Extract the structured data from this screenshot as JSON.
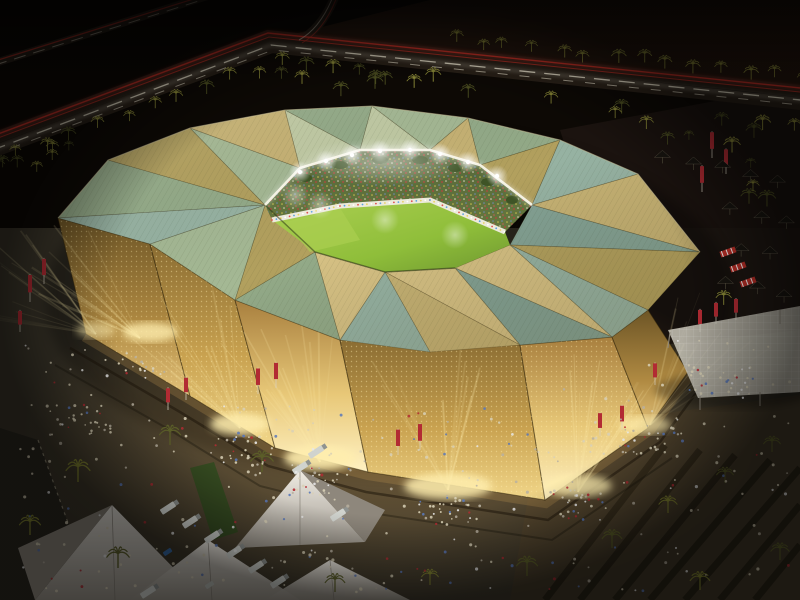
{
  "scene": {
    "alt": "Night aerial architectural rendering of a golden stadium with a folded green-and-gold faceted roof, an open glowing bowl with floodlit pitch and packed stands, perforated gold walls beaming light onto terraced plazas with crowds, red banners, palm trees, white tents with trucks, parasol rows, a mesh event canopy and a highway with red and white light trails"
  },
  "palette": {
    "sky": "#140d07",
    "ground_dark": "#0d0905",
    "ground_warm": "#2a1a10",
    "plaza": "#3b362a",
    "plaza_warm": "#6a583a",
    "road": "#2a2118",
    "trail_red": "#d63328",
    "trail_white": "#f0e8d2",
    "palm_dark": "#4f5222",
    "palm_lit": "#95943c",
    "palm_fore": "#5c5f28",
    "roof_sage": "#a4b894",
    "roof_sage2": "#93aa88",
    "roof_teal": "#96b2a2",
    "roof_teal2": "#84a294",
    "roof_pale": "#c0caa4",
    "roof_gold": "#c6b274",
    "roof_gold2": "#b2a05e",
    "roof_gold3": "#d6c184",
    "wall_top": "#8a6c32",
    "wall_gold": "#c9a250",
    "wall_bright": "#f2d78a",
    "glow": "#ffeeae",
    "pitch": "#8fbe3a",
    "pitch_light": "#accf52",
    "pitch_dark": "#6f9830",
    "stands": "#66783e",
    "stands_dark": "#55673a",
    "rim_band": "#eceadb",
    "cornice": "#f8f4e4",
    "banner_red": "#b22b33",
    "tent": "#dcd7cd",
    "tent_shadow": "#8e877c",
    "truck": "#d0d3ce",
    "car_blue": "#3a6fae",
    "canopy": "#c9c6b8",
    "crowd": "#d8d0b6",
    "foliage": "#3e5426",
    "stall_red": "#c03028"
  }
}
